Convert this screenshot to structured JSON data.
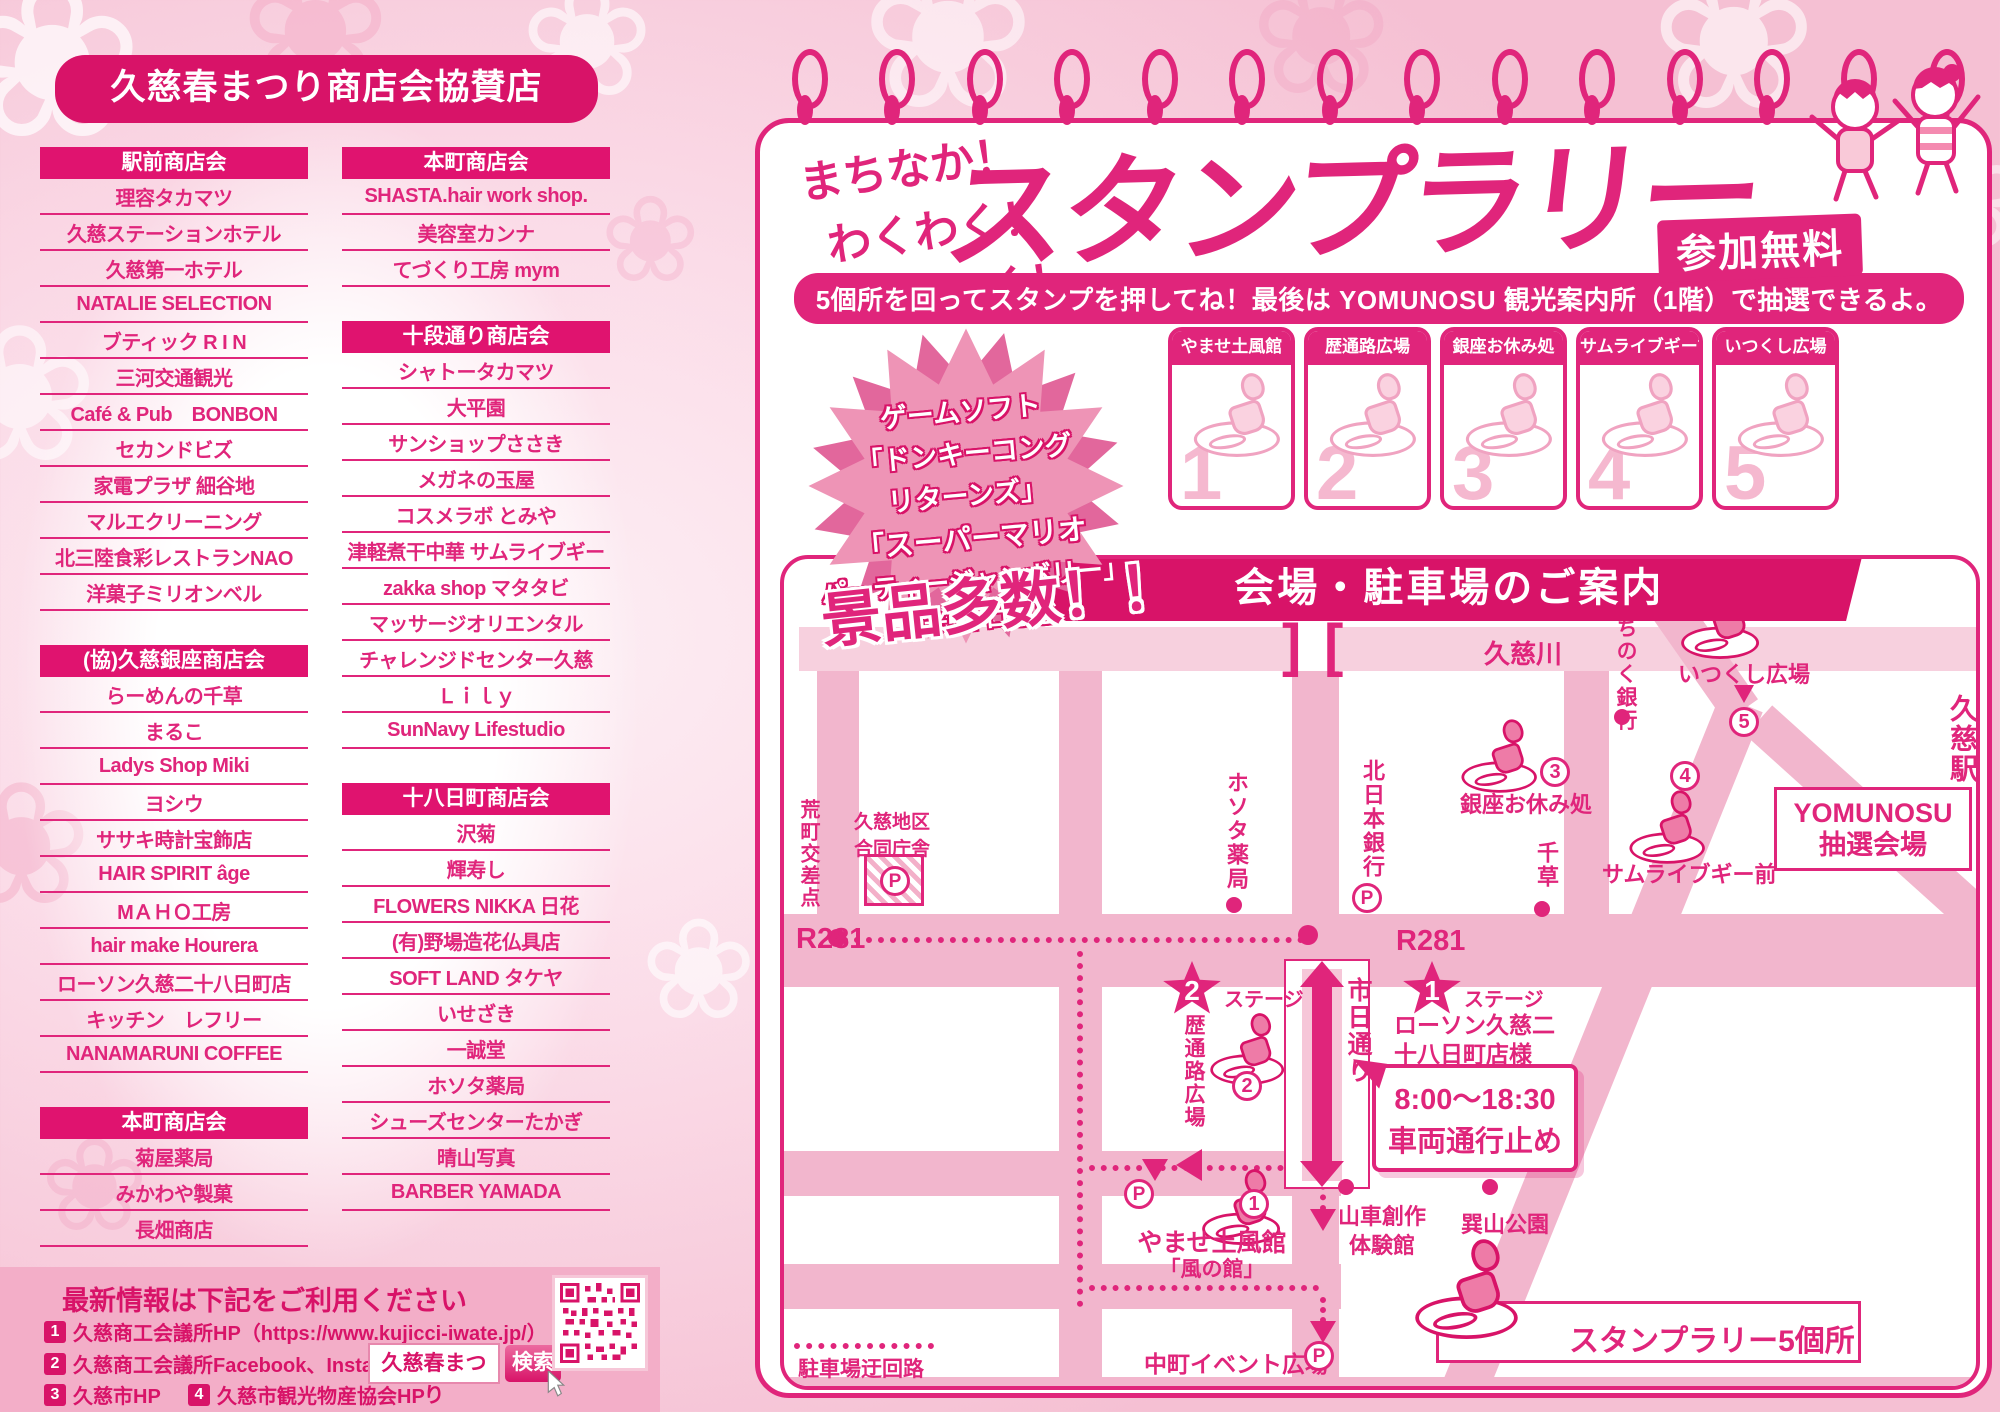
{
  "left_panel": {
    "title": "久慈春まつり商店会協賛店",
    "col1_sections": [
      {
        "header": "駅前商店会",
        "items": [
          "理容タカマツ",
          "久慈ステーションホテル",
          "久慈第一ホテル",
          "NATALIE SELECTION",
          "ブティック R I N",
          "三河交通観光",
          "Café & Pub　BONBON",
          "セカンドビズ",
          "家電プラザ 細谷地",
          "マルエクリーニング",
          "北三陸食彩レストランNAO",
          "洋菓子ミリオンベル"
        ]
      },
      {
        "header": "(協)久慈銀座商店会",
        "items": [
          "らーめんの千草",
          "まるこ",
          "Ladys Shop Miki",
          "ヨシウ",
          "ササキ時計宝飾店",
          "HAIR SPIRIT âge",
          "МＡＨＯ工房",
          "hair make Hourera",
          "ローソン久慈二十八日町店",
          "キッチン　レフリー",
          "NANAMARUNI COFFEE"
        ]
      },
      {
        "header": "本町商店会",
        "items": [
          "菊屋薬局",
          "みかわや製菓",
          "長畑商店"
        ]
      }
    ],
    "col2_sections": [
      {
        "header": "本町商店会",
        "items": [
          "SHASTA.hair work shop.",
          "美容室カンナ",
          "てづくり工房 mym"
        ]
      },
      {
        "header": "十段通り商店会",
        "items": [
          "シャトータカマツ",
          "大平園",
          "サンショップささき",
          "メガネの玉屋",
          "コスメラボ とみや",
          "津軽煮干中華 サムライブギー",
          "zakka shop マタタビ",
          "マッサージオリエンタル",
          "チャレンジドセンター久慈",
          "Ｌｉｌｙ",
          "SunNavy Lifestudio"
        ]
      },
      {
        "header": "十八日町商店会",
        "items": [
          "沢菊",
          "輝寿し",
          "FLOWERS NIKKA 日花",
          "(有)野場造花仏具店",
          "SOFT LAND タケヤ",
          "いせざき",
          "一誠堂",
          "ホソタ薬局",
          "シューズセンターたかぎ",
          "晴山写真",
          "BARBER YAMADA"
        ]
      }
    ],
    "info": {
      "title": "最新情報は下記をご利用ください",
      "line1_num": "1",
      "line1": "久慈商工会議所HP（https://www.kujicci-iwate.jp/）",
      "line2_num": "2",
      "line2": "久慈商工会議所Facebook、Instagram",
      "line3_num": "3",
      "line3": "久慈市HP",
      "line4_num": "4",
      "line4": "久慈市観光物産協会HP",
      "search_value": "久慈春まつり",
      "search_button": "検索"
    }
  },
  "stamp_rally": {
    "intro_lines": [
      "まちなか！",
      "わくわく！",
      "てくてく！"
    ],
    "title": "スタンプラリー",
    "free_badge": "参加無料",
    "instruction": "5個所を回ってスタンプを押してね！最後は YOMUNOSU 観光案内所（1階）で抽選できるよ。",
    "prizes_note_lines": [
      "ゲームソフト",
      "「ドンキーコング",
      "リターンズ」",
      "「スーパーマリオ",
      "パーティージャンボリー」",
      "お米5キロなど"
    ],
    "prizes_highlight": "景品多数！！",
    "stamp_spots": [
      {
        "no": "1",
        "label": "やませ土風館"
      },
      {
        "no": "2",
        "label": "歴通路広場"
      },
      {
        "no": "3",
        "label": "銀座お休み処"
      },
      {
        "no": "4",
        "label": "サムライブギー前"
      },
      {
        "no": "5",
        "label": "いつくし広場"
      }
    ]
  },
  "map": {
    "title": "会場・駐車場のご案内",
    "river": "久慈川",
    "bridge_l": "]",
    "bridge_r": "[",
    "r281": "R281",
    "p": "P",
    "stage_label": "ステージ",
    "stages": [
      {
        "no": "2"
      },
      {
        "no": "1"
      }
    ],
    "labels": {
      "crossing": "荒町交差点",
      "gov": "久慈地区合同庁舎",
      "hosota": "ホソタ薬局",
      "kitanihon": "北日本銀行",
      "chigusa": "千草",
      "michinoku": "みちのく銀行",
      "itsukushi": "いつくし広場",
      "station": "久慈駅",
      "ichinichi": "市日通り",
      "rekimichi": "歴通路広場",
      "lawson": "ローソン久慈二十八日町店様",
      "ginza": "銀座お休み処",
      "samurai": "サムライブギー前",
      "yomunosu1": "YOMUNOSU",
      "yomunosu2": "抽選会場",
      "yamase": "やませ土風館",
      "kaze": "「風の館」",
      "dashi": "山車創作体験館",
      "tatsuyama": "巽山公園",
      "nakamachi": "中町イベント広場",
      "detour": "駐車場迂回路",
      "legend": "スタンプラリー5個所"
    },
    "notice": {
      "line1": "8:00〜18:30",
      "line2": "車両通行止め"
    }
  },
  "colors": {
    "accent": "#e0257b",
    "deep": "#d81368",
    "road": "#f2b6cd",
    "band": "#f3aec8"
  }
}
